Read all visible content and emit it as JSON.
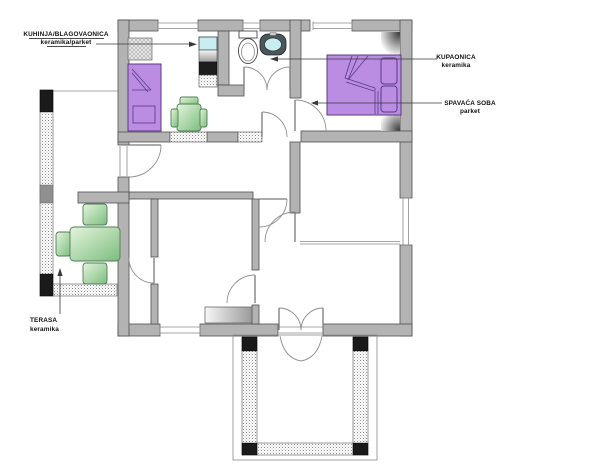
{
  "diagram": {
    "type": "apartment-floor-plan",
    "labels": {
      "kitchen_dining": {
        "title": "KUHINJA/BLAGOVAONICA",
        "subtitle": "keramika/parket"
      },
      "bathroom": {
        "title": "KUPAONICA",
        "subtitle": "keramika"
      },
      "bedroom": {
        "title": "SPAVAĆA SOBA",
        "subtitle": "parket"
      },
      "terrace": {
        "title": "TERASA",
        "subtitle": "keramika"
      }
    },
    "colors": {
      "background": "#ffffff",
      "wall": "#b3b3b3",
      "wall_outline": "#4f4f4f",
      "furniture_purple": "#ba8ce2",
      "furniture_purple_outline": "#5a3a82",
      "furniture_green_light": "#e4f4dd",
      "furniture_green_dark": "#7cbd7e",
      "fixture_teal": "#c9eef1",
      "stove_black": "#1d1d1d",
      "railing_post": "#1a1a1a"
    }
  }
}
